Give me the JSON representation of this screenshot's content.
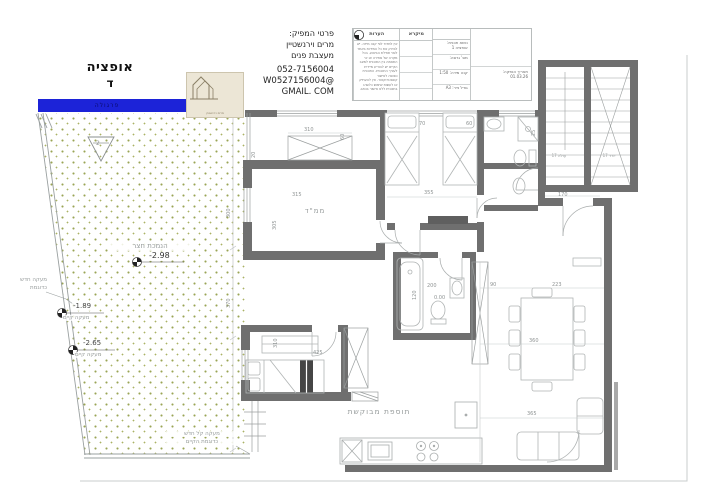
{
  "header": {
    "option_title": "אופציה",
    "option_letter": "ד",
    "logo_caption": "מרים וירנשטיין",
    "producer": {
      "title": "פרטי המפיק:",
      "name": "מרים וירנשטיין",
      "role": "מעצבת פנים",
      "phone": "052-7156004",
      "email_line1": "W0527156004@",
      "email_line2": "GMAIL. COM"
    },
    "notes_header": "הערות",
    "legend_header": "מיקרא",
    "notes_text": "אין למדוד לפי קנה מידה. יש לבדוק את כל המידות באתר לפני תחילת הביצוע. בכל מקרה של סתירה או אי התאמה בין התוכנית למצב הקיים יש להודיע מיידית לעורך התוכנית. התוכנית כפופה לאישור קונסטרוקטור. אין להעתיק או לעשות שימוש כלשהו בתוכנית ללא אישור בכתב.",
    "info": {
      "r1a": "נושא תכנית:",
      "r1b": "אופציה 1",
      "r2": "מס' גרסה:",
      "r3": "קנה מידה: 1:50",
      "r4": "גודל נייר: A3",
      "date_label": "תאריך הנפקה:",
      "date_value": "01.03.26"
    }
  },
  "plan": {
    "rooms": {
      "mamad": "ממ\"ד"
    },
    "labels": {
      "addition": "תוספת מבוקשת",
      "yard": "הנמכת חצר",
      "yard_level": "-2.98",
      "level_1": "-1.89",
      "level_2": "-2.65",
      "railing_existing_1": "מעקה קיים",
      "railing_existing_2": "מעקה קיים",
      "railing_new_line1": "מעקה חדש",
      "railing_new_line2": "כדוגמת",
      "railing_light_line1": "מעקה קל חדש",
      "railing_light_line2": "כדוגמת הקיים",
      "stairs_up": "עולה 17",
      "stairs_down": "יורד 17",
      "pergola": "פרגולה",
      "zero_level": "0.00",
      "section_mark": "2"
    },
    "dims": {
      "d20": "20",
      "d25": "25",
      "d60a": "60",
      "d60b": "60",
      "d70": "70",
      "d90": "90",
      "d120": "120",
      "d170": "170",
      "d200": "200",
      "d223": "223",
      "d300": "300",
      "d305": "305",
      "d310a": "310",
      "d310b": "310",
      "d315": "315",
      "d355": "355",
      "d360": "360",
      "d365": "365",
      "d370": "370",
      "d425": "425"
    }
  },
  "colors": {
    "wall": "#6f6f6f",
    "pergola_bar": "#1c23d8",
    "existing_bar": "#8f8f8f",
    "garden_dot": "#9aa455",
    "line": "#a9adad",
    "dim_text": "#8f9494"
  }
}
